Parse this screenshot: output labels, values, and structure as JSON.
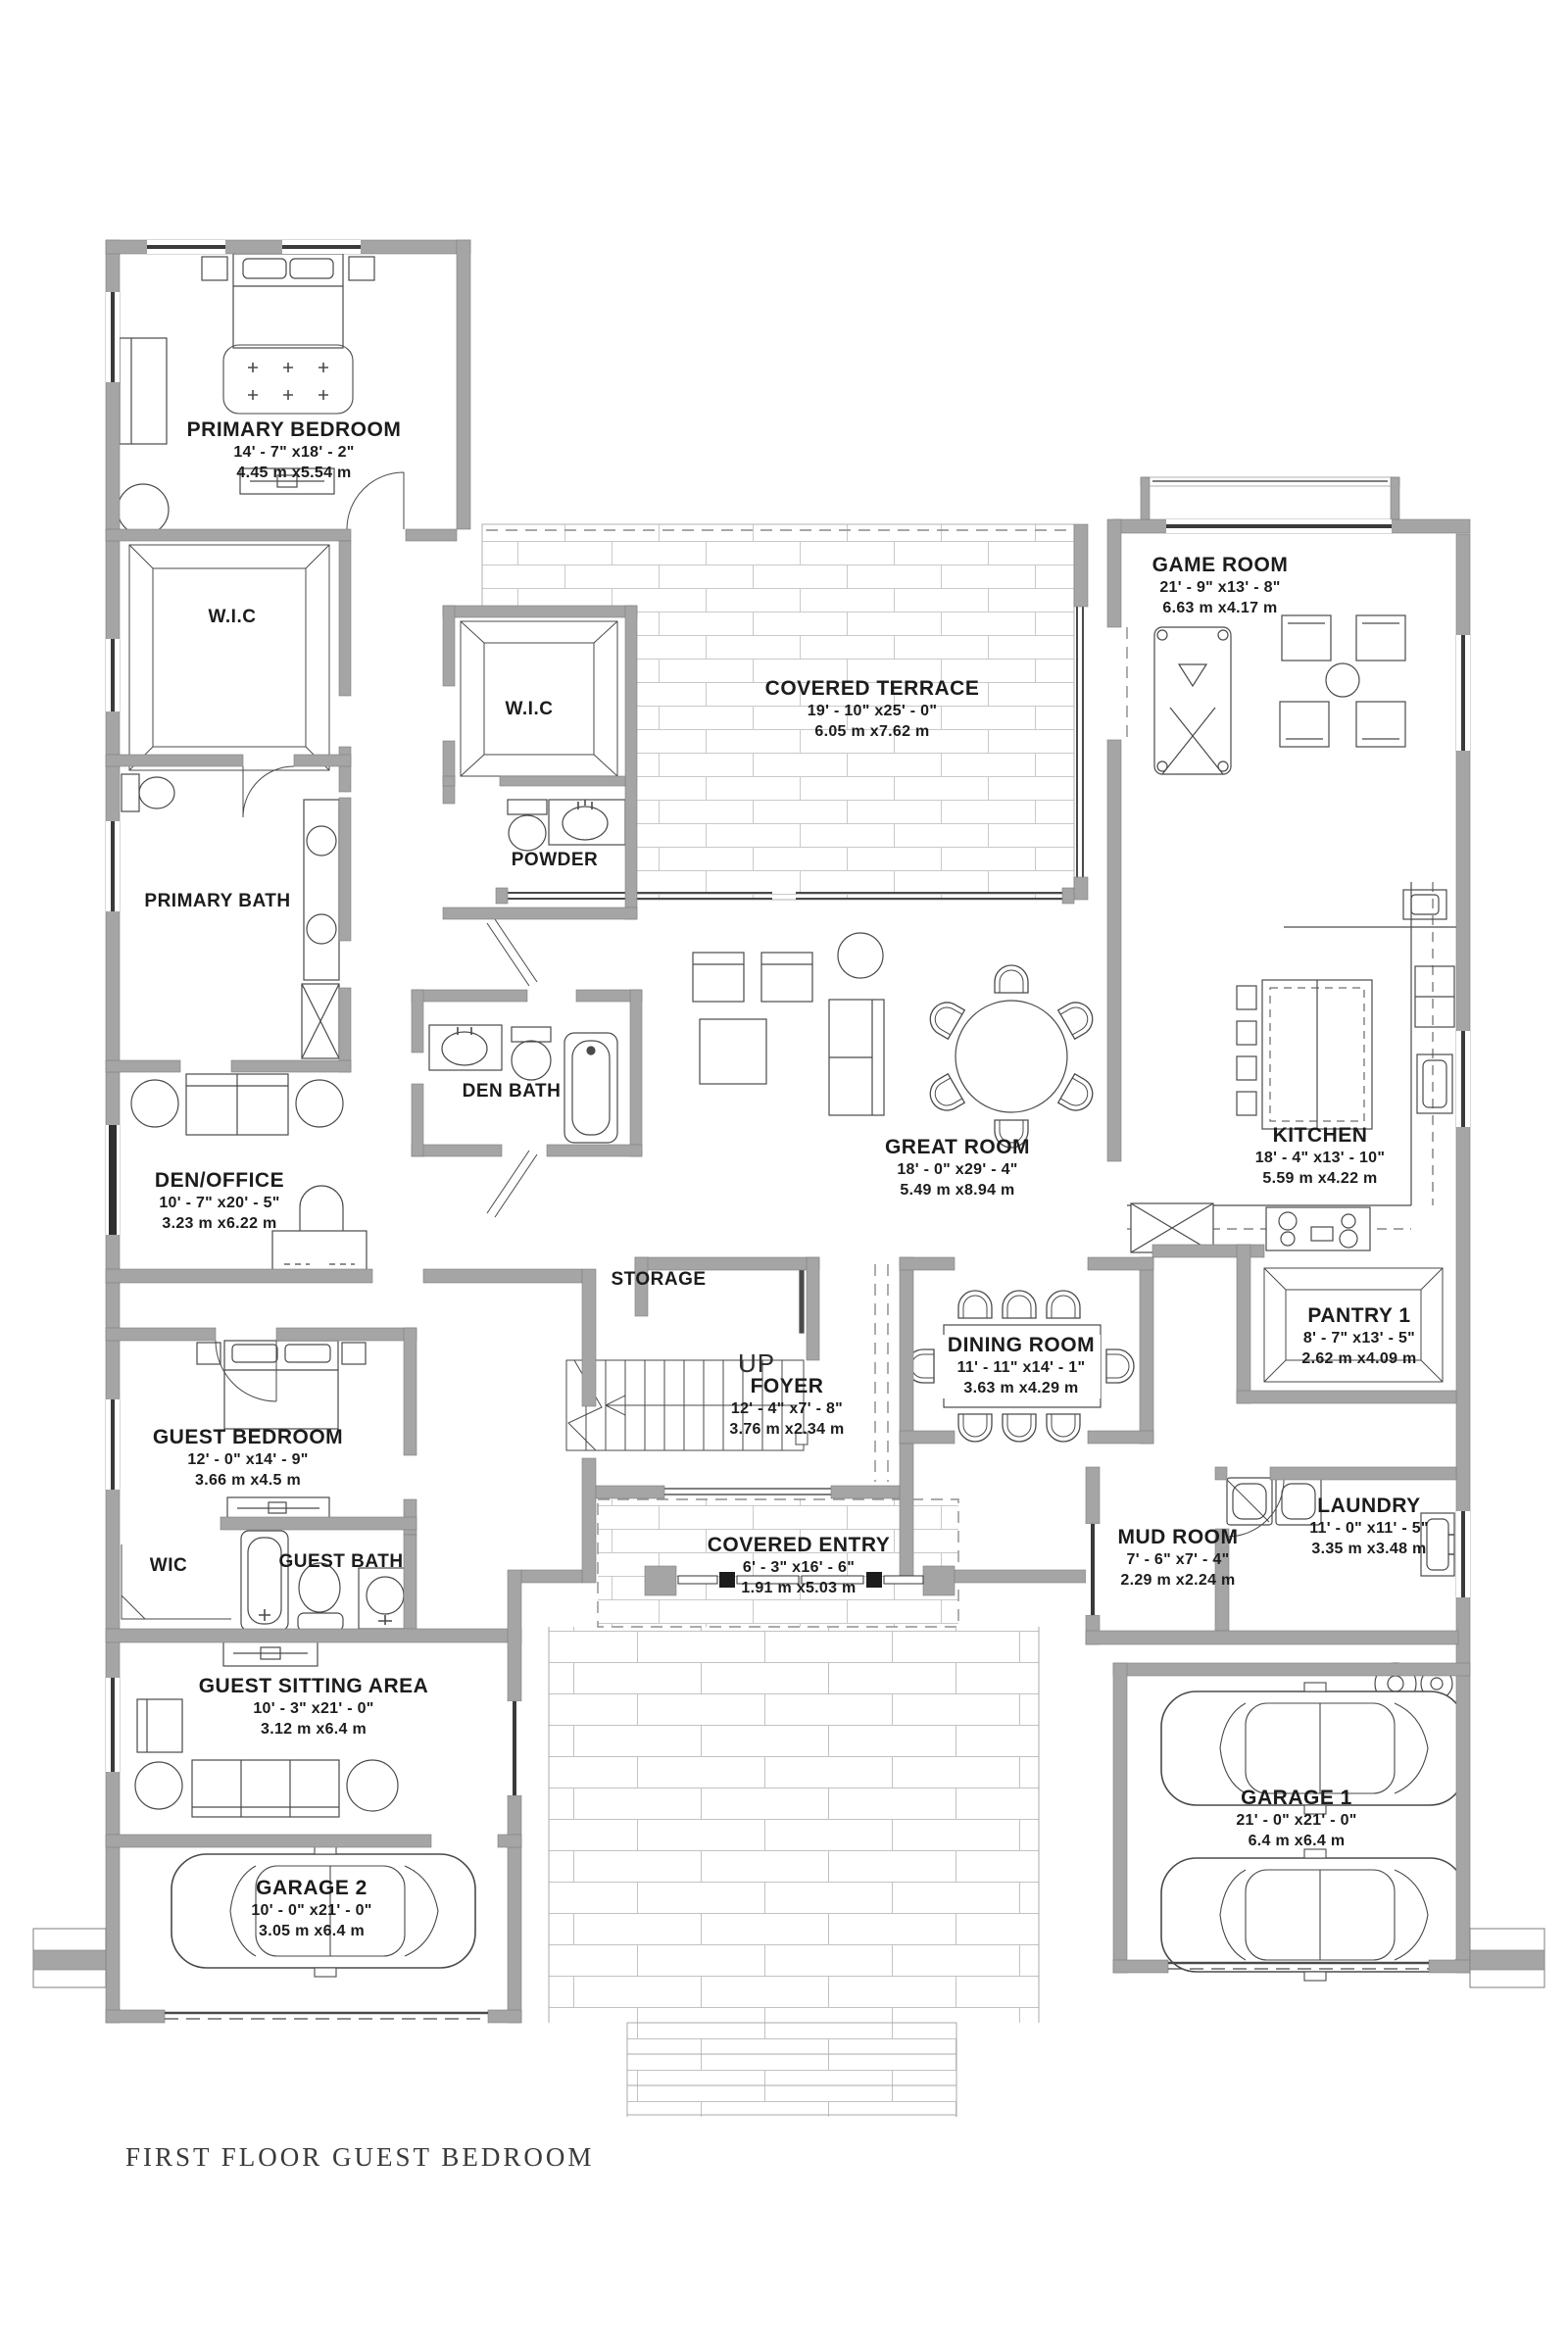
{
  "plan": {
    "footer_title": "FIRST FLOOR GUEST BEDROOM",
    "stair_label": "UP",
    "rooms": {
      "primary_bedroom": {
        "name": "PRIMARY BEDROOM",
        "imperial": "14' - 7\" x18' - 2\"",
        "metric": "4.45 m x5.54 m"
      },
      "wic_primary": {
        "name": "W.I.C"
      },
      "wic_hall": {
        "name": "W.I.C"
      },
      "powder": {
        "name": "POWDER"
      },
      "primary_bath": {
        "name": "PRIMARY BATH"
      },
      "den_bath": {
        "name": "DEN BATH"
      },
      "covered_terrace": {
        "name": "COVERED TERRACE",
        "imperial": "19' - 10\" x25' - 0\"",
        "metric": "6.05 m x7.62 m"
      },
      "game_room": {
        "name": "GAME ROOM",
        "imperial": "21' - 9\" x13' - 8\"",
        "metric": "6.63 m x4.17 m"
      },
      "great_room": {
        "name": "GREAT ROOM",
        "imperial": "18' - 0\" x29' - 4\"",
        "metric": "5.49 m x8.94 m"
      },
      "kitchen": {
        "name": "KITCHEN",
        "imperial": "18' - 4\" x13' - 10\"",
        "metric": "5.59 m x4.22 m"
      },
      "den_office": {
        "name": "DEN/OFFICE",
        "imperial": "10' - 7\" x20' - 5\"",
        "metric": "3.23 m x6.22 m"
      },
      "storage": {
        "name": "STORAGE"
      },
      "foyer": {
        "name": "FOYER",
        "imperial": "12' - 4\" x7' - 8\"",
        "metric": "3.76 m x2.34 m"
      },
      "dining_room": {
        "name": "DINING ROOM",
        "imperial": "11' - 11\" x14' - 1\"",
        "metric": "3.63 m x4.29 m"
      },
      "pantry1": {
        "name": "PANTRY 1",
        "imperial": "8' - 7\" x13' - 5\"",
        "metric": "2.62 m x4.09 m"
      },
      "guest_bedroom": {
        "name": "GUEST BEDROOM",
        "imperial": "12' - 0\" x14' - 9\"",
        "metric": "3.66 m x4.5 m"
      },
      "wic_guest": {
        "name": "WIC"
      },
      "guest_bath": {
        "name": "GUEST BATH"
      },
      "laundry": {
        "name": "LAUNDRY",
        "imperial": "11' - 0\" x11' - 5\"",
        "metric": "3.35 m x3.48 m"
      },
      "mud_room": {
        "name": "MUD ROOM",
        "imperial": "7' - 6\" x7' - 4\"",
        "metric": "2.29 m x2.24 m"
      },
      "covered_entry": {
        "name": "COVERED ENTRY",
        "imperial": "6' - 3\" x16' - 6\"",
        "metric": "1.91 m x5.03 m"
      },
      "guest_sitting": {
        "name": "GUEST SITTING AREA",
        "imperial": "10' - 3\" x21' - 0\"",
        "metric": "3.12 m x6.4 m"
      },
      "garage2": {
        "name": "GARAGE 2",
        "imperial": "10' - 0\" x21' - 0\"",
        "metric": "3.05 m x6.4 m"
      },
      "garage1": {
        "name": "GARAGE 1",
        "imperial": "21' - 0\" x21' - 0\"",
        "metric": "6.4 m x6.4 m"
      }
    }
  }
}
